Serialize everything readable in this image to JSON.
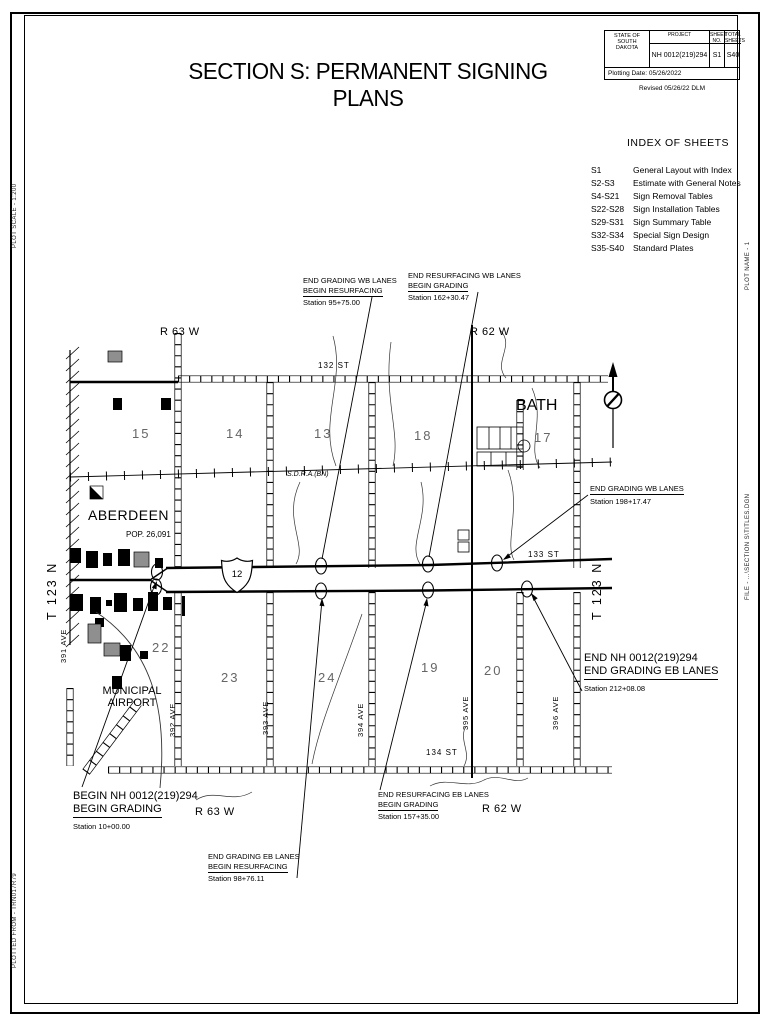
{
  "sheet": {
    "title": "SECTION S: PERMANENT SIGNING PLANS",
    "title_block": {
      "state_line1": "STATE OF",
      "state_line2": "SOUTH",
      "state_line3": "DAKOTA",
      "project_label": "PROJECT",
      "project_value": "NH 0012(219)294",
      "sheet_no_label": "SHEET NO.",
      "sheet_no_value": "S1",
      "total_sheets_label": "TOTAL SHEETS",
      "total_sheets_value": "S40",
      "plotting_date": "Plotting Date: 05/26/2022",
      "revised": "Revised 05/26/22 DLM"
    },
    "margin_notes": {
      "plot_scale": "PLOT SCALE - 1:200",
      "plotted_from": "PLOTTED FROM - TRN017R79",
      "plot_name": "PLOT NAME - 1",
      "file_path": "FILE - ...\\SECTION S\\TITLES.DGN"
    }
  },
  "index_of_sheets": {
    "title": "INDEX OF SHEETS",
    "entries": [
      {
        "sheets": "S1",
        "description": "General Layout with Index"
      },
      {
        "sheets": "S2-S3",
        "description": "Estimate with General Notes"
      },
      {
        "sheets": "S4-S21",
        "description": "Sign Removal Tables"
      },
      {
        "sheets": "S22-S28",
        "description": "Sign Installation Tables"
      },
      {
        "sheets": "S29-S31",
        "description": "Sign Summary Table"
      },
      {
        "sheets": "S32-S34",
        "description": "Special Sign Design"
      },
      {
        "sheets": "S35-S40",
        "description": "Standard Plates"
      }
    ]
  },
  "map": {
    "range_top_left": "R 63 W",
    "range_top_right": "R 62 W",
    "range_bottom_left": "R 63 W",
    "range_bottom_right": "R 62 W",
    "township_left": "T 123 N",
    "township_right": "T 123 N",
    "st_132": "132 ST",
    "st_133": "133 ST",
    "st_134": "134 ST",
    "ave_391": "391 AVE",
    "ave_392": "392 AVE",
    "ave_393": "393 AVE",
    "ave_394": "394 AVE",
    "ave_395": "395 AVE",
    "ave_396": "396 AVE",
    "railroad": "S.D.R.A.(BN)",
    "city_name": "ABERDEEN",
    "city_pop": "POP. 26,091",
    "town_bath": "BATH",
    "airport_line1": "MUNICIPAL",
    "airport_line2": "AIRPORT",
    "route_shield": "12",
    "sections": {
      "s15": "15",
      "s14": "14",
      "s13": "13",
      "s18": "18",
      "s17": "17",
      "s22": "22",
      "s23": "23",
      "s24": "24",
      "s19": "19",
      "s20": "20"
    }
  },
  "callouts": {
    "wb_resurf": {
      "l1": "END GRADING WB LANES",
      "l2": "BEGIN RESURFACING",
      "station": "Station 95+75.00"
    },
    "wb_grading": {
      "l1": "END RESURFACING WB LANES",
      "l2": "BEGIN GRADING",
      "station": "Station 162+30.47"
    },
    "wb_end": {
      "l1": "END GRADING WB LANES",
      "station": "Station 198+17.47"
    },
    "project_end": {
      "l1": "END NH 0012(219)294",
      "l2": "END GRADING EB LANES",
      "station": "Station 212+08.08"
    },
    "project_begin": {
      "l1": "BEGIN NH 0012(219)294",
      "l2": "BEGIN GRADING",
      "station": "Station 10+00.00"
    },
    "eb_resurf": {
      "l1": "END GRADING EB LANES",
      "l2": "BEGIN RESURFACING",
      "station": "Station 98+76.11"
    },
    "eb_grading": {
      "l1": "END RESURFACING EB LANES",
      "l2": "BEGIN GRADING",
      "station": "Station 157+35.00"
    }
  }
}
